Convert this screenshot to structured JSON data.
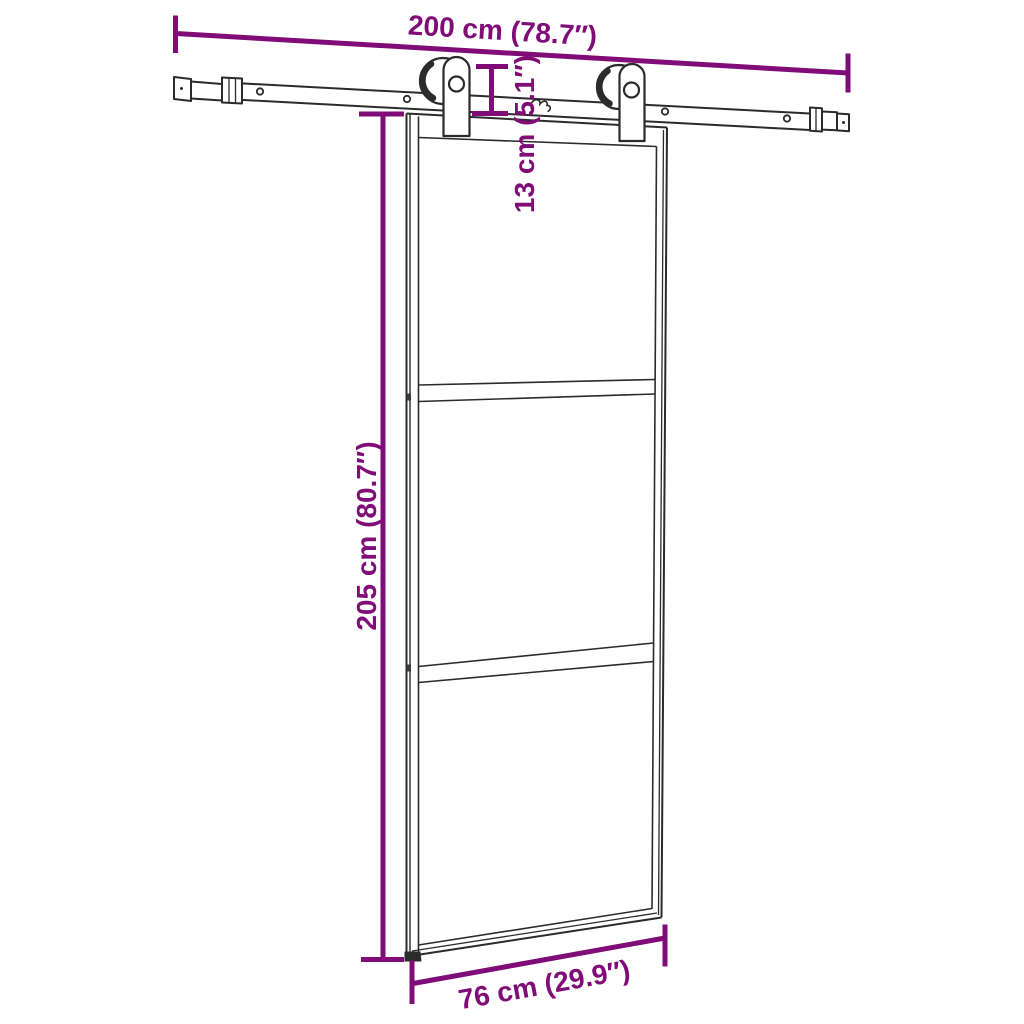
{
  "colors": {
    "dimension": "#800c78",
    "outline": "#2b2b2b",
    "background": "#ffffff"
  },
  "labels": {
    "track_width": "200 cm (78.7″)",
    "hanger_height": "13 cm (5.1″)",
    "door_height": "205 cm (80.7″)",
    "door_width": "76 cm (29.9″)"
  },
  "artwork": {
    "components": [
      "sliding-track-rail",
      "track-end-stopper-left",
      "track-end-stopper-right",
      "roller-hanger-left",
      "roller-hanger-right",
      "glass-door-panel",
      "door-divider-rail-upper",
      "door-divider-rail-lower",
      "floor-guide-foot"
    ]
  }
}
